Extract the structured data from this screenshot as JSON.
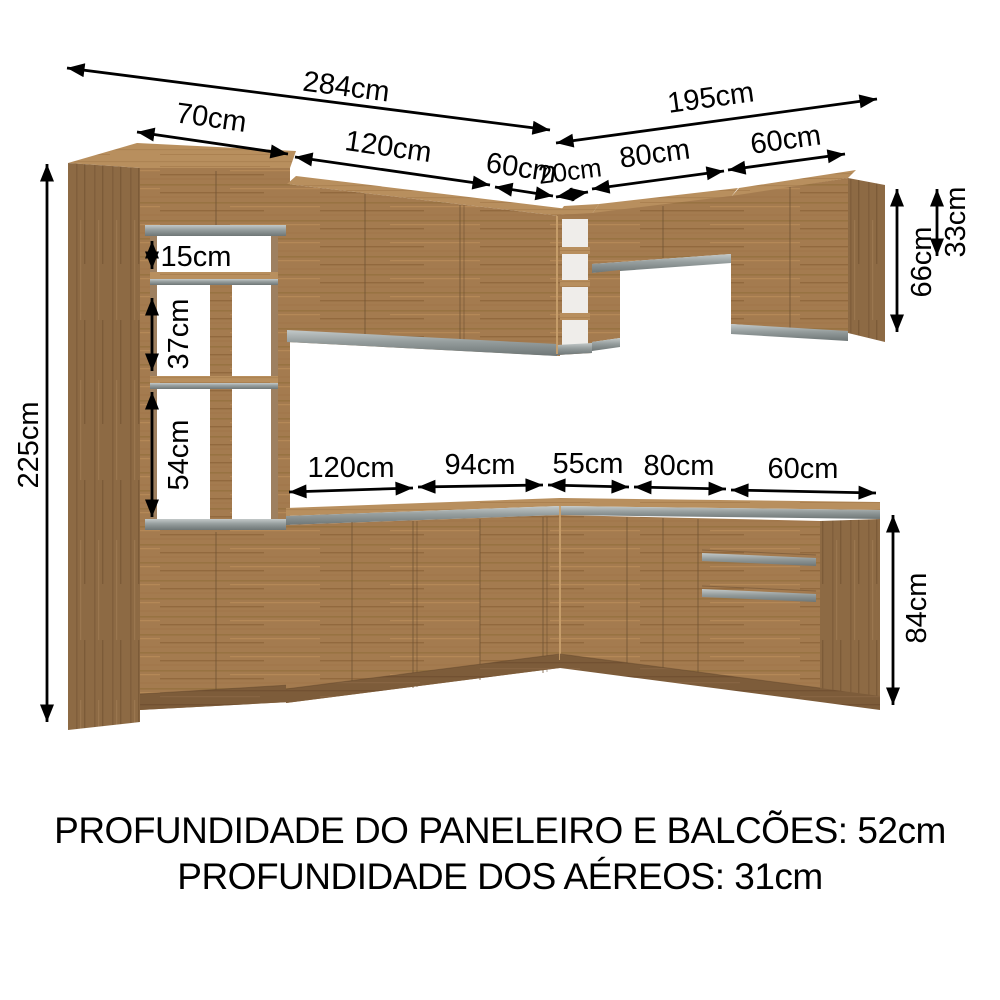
{
  "image_type": "kitchen-cabinet-dimension-diagram",
  "footer": {
    "line1": "PROFUNDIDADE DO PANELEIRO E BALCÕES: 52cm",
    "line2": "PROFUNDIDADE DOS AÉREOS: 31cm"
  },
  "dims": {
    "overall_left": "284cm",
    "overall_right": "195cm",
    "paneleiro_w": "70cm",
    "upper_left_120": "120cm",
    "upper_left_60": "60cm",
    "corner_nicho": "20cm",
    "upper_right_80": "80cm",
    "upper_right_60": "60cm",
    "total_height": "225cm",
    "shelf_gap_top": "15cm",
    "shelf_gap_mid": "37cm",
    "shelf_gap_bottom": "54cm",
    "upper_right_h": "66cm",
    "upper_right_small_h": "33cm",
    "base_120": "120cm",
    "base_94": "94cm",
    "base_55": "55cm",
    "base_80": "80cm",
    "base_60": "60cm",
    "base_h": "84cm"
  },
  "colors": {
    "wood_front": "#a47b4f",
    "wood_side": "#8d6a44",
    "wood_top": "#b88f5e",
    "plinth": "#7d5c3a",
    "aluminum_rail": "#959d9d",
    "text": "#000000",
    "background": "#ffffff"
  }
}
